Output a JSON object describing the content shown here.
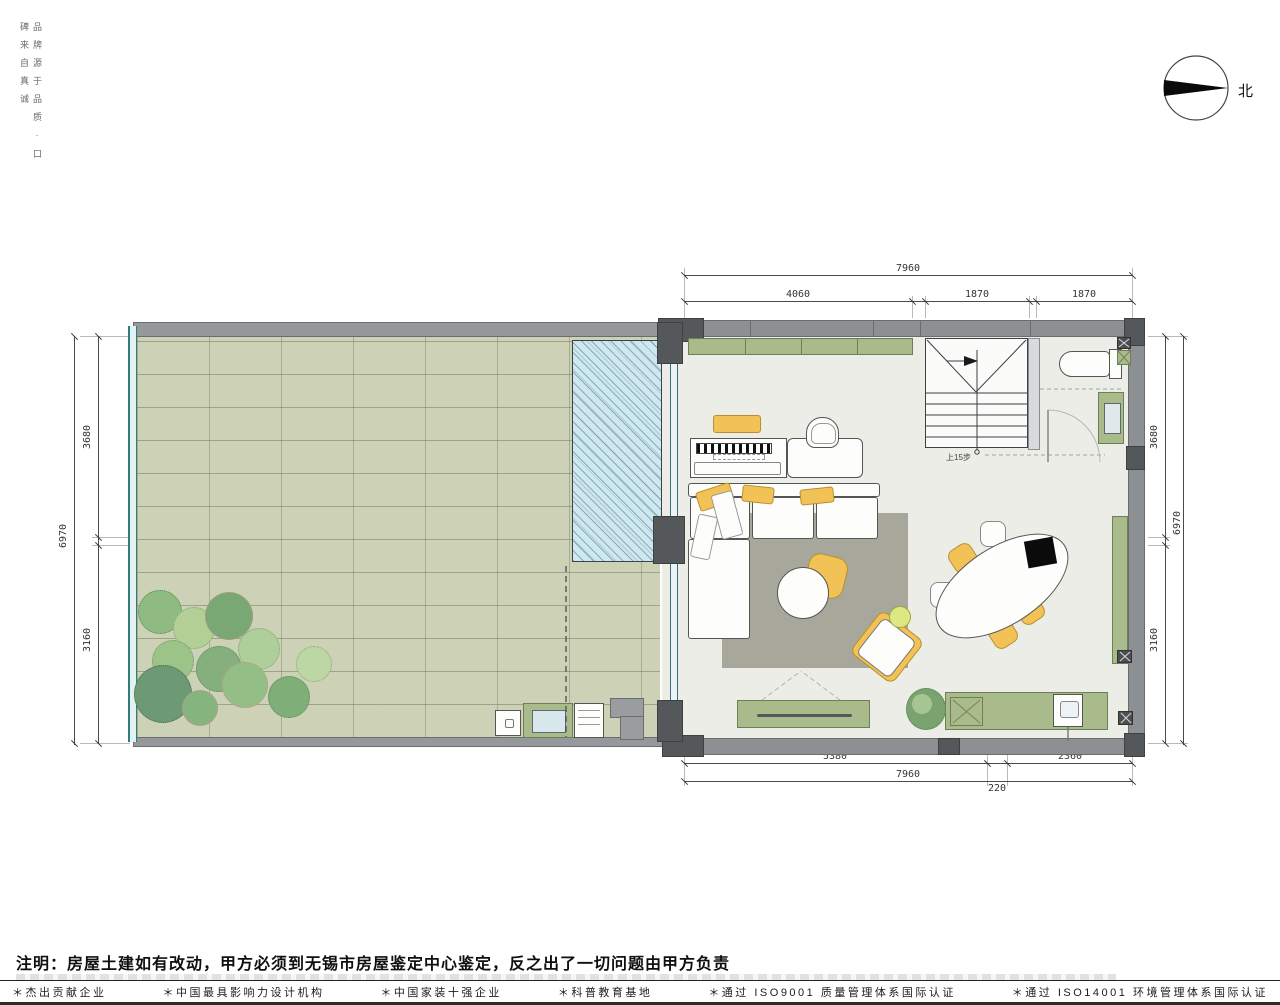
{
  "slogan": {
    "text": "品牌源于品质·口碑来自真诚"
  },
  "compass": {
    "label": "北"
  },
  "dimensions": {
    "top": {
      "overall": "7960",
      "segments": [
        "4060",
        "1870",
        "1870"
      ]
    },
    "left": {
      "overall": "6970",
      "segments": [
        "3680",
        "3160"
      ]
    },
    "right": {
      "overall": "6970",
      "segments": [
        "3680",
        "3160"
      ]
    },
    "bottom": {
      "overall": "7960",
      "segments": [
        "5380",
        "220",
        "2360"
      ]
    }
  },
  "plan": {
    "stair_label": "上15步"
  },
  "note": {
    "text": "注明：房屋土建如有改动，甲方必须到无锡市房屋鉴定中心鉴定，反之出了一切问题由甲方负责"
  },
  "footer": {
    "items": [
      "＊杰出贡献企业",
      "＊中国最具影响力设计机构",
      "＊中国家装十强企业",
      "＊科普教育基地",
      "＊通过 ISO9001 质量管理体系国际认证",
      "＊通过 ISO14001 环境管理体系国际认证"
    ]
  },
  "colors": {
    "wall": "#8d9092",
    "paver": "#cdd1b6",
    "pool": "#cfe7ee",
    "cabinet_green": "#aabb8b",
    "accent_yellow": "#f2c257",
    "rug": "#a7a89b",
    "floor": "#ecede7"
  }
}
